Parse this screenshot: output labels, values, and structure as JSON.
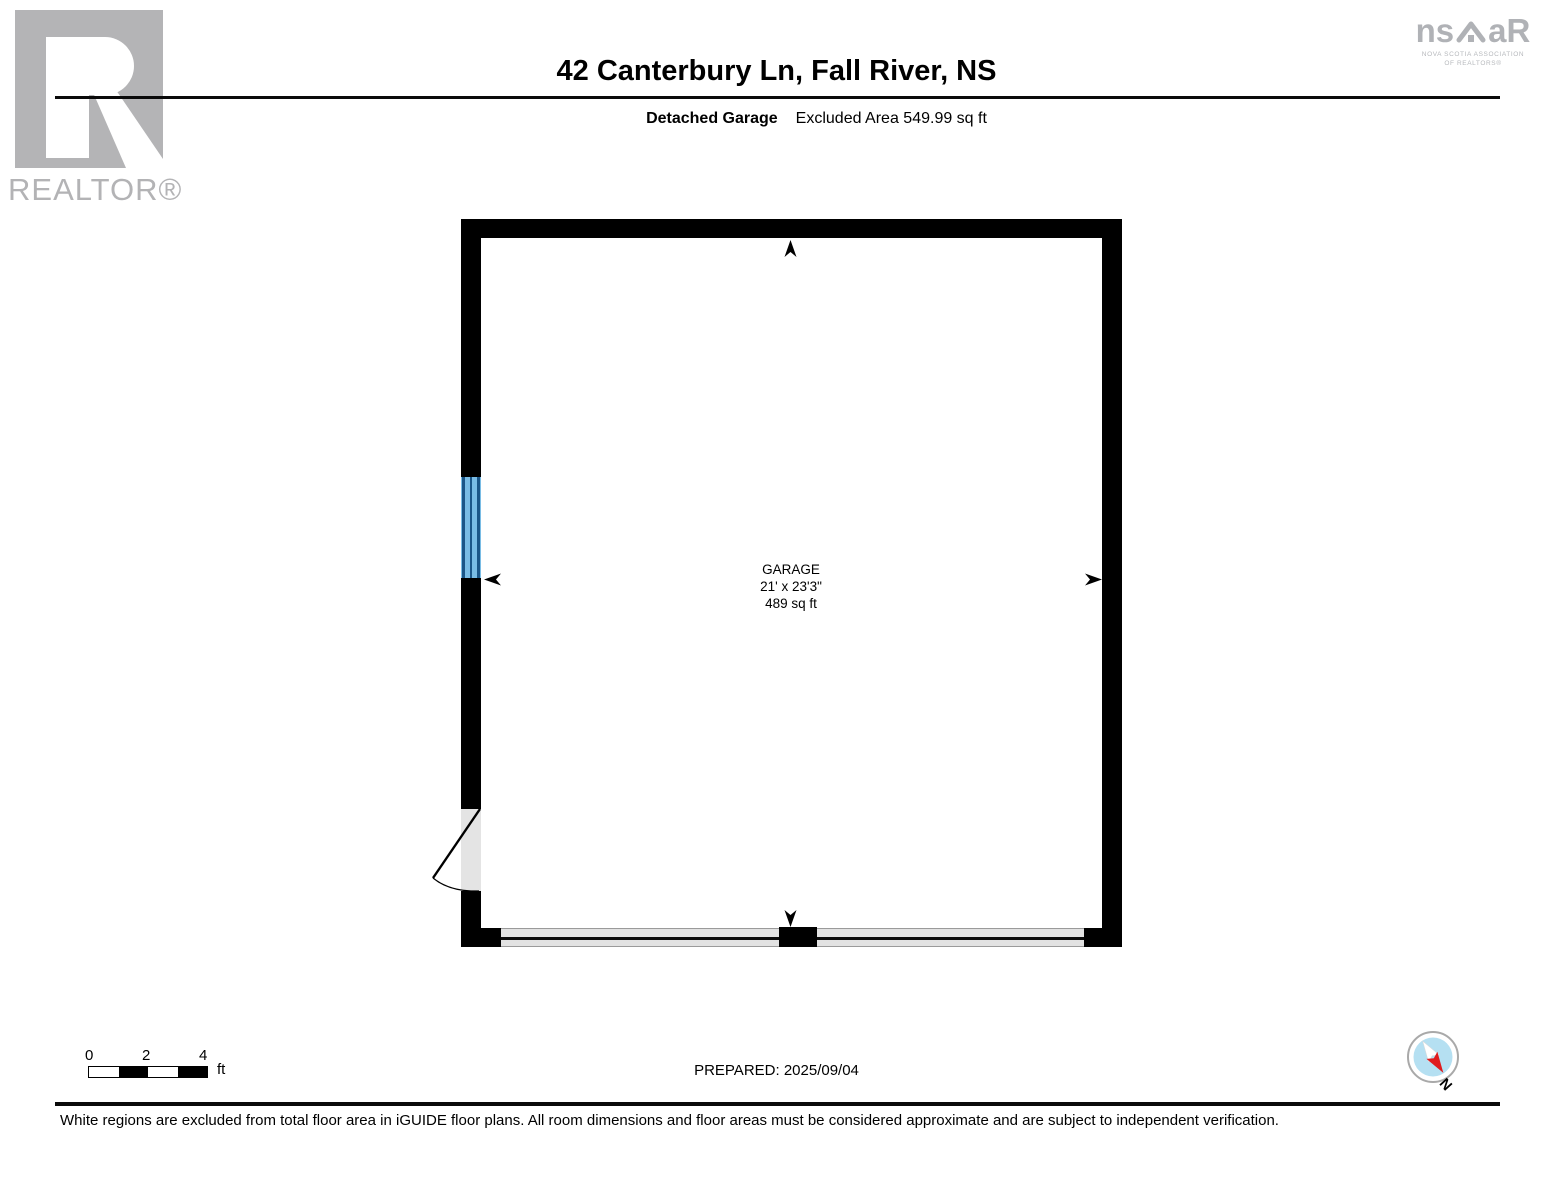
{
  "header": {
    "title": "42 Canterbury Ln, Fall River, NS",
    "subtitle_bold": "Detached Garage",
    "subtitle_regular": "Excluded Area 549.99 sq ft"
  },
  "branding": {
    "realtor_wordmark": "REALTOR®",
    "nsar": {
      "left": "ns",
      "right": "aR",
      "line1": "NOVA SCOTIA ASSOCIATION",
      "line2": "OF REALTORS®"
    }
  },
  "floorplan": {
    "room": {
      "name": "GARAGE",
      "dimensions": "21' x 23'3\"",
      "area": "489 sq ft"
    }
  },
  "scalebar": {
    "tick0": "0",
    "tick1": "2",
    "tick2": "4",
    "unit": "ft"
  },
  "footer": {
    "prepared": "PREPARED: 2025/09/04",
    "compass_label": "N",
    "disclaimer": "White regions are excluded from total floor area in iGUIDE floor plans. All room dimensions and floor areas must be considered approximate and are subject to independent verification."
  },
  "icons": {
    "realtor_logo": "realtor-block-r-logo",
    "nsar_logo": "nsar-house-logo",
    "compass": "compass-north-icon",
    "window": "window-symbol",
    "door": "door-swing-symbol",
    "garage_door": "garage-door-symbol",
    "arrows": [
      "arrow-up-icon",
      "arrow-down-icon",
      "arrow-left-icon",
      "arrow-right-icon"
    ]
  },
  "colors": {
    "wall": "#000000",
    "window_fill": "#79bce5",
    "window_frame": "#1b5688",
    "opening_fill": "#e4e4e4",
    "garage_band_fill": "#e2e2e2",
    "compass_blue": "#b5e0f2",
    "compass_red": "#e01b1e",
    "logo_gray": "#b4b4b6"
  }
}
